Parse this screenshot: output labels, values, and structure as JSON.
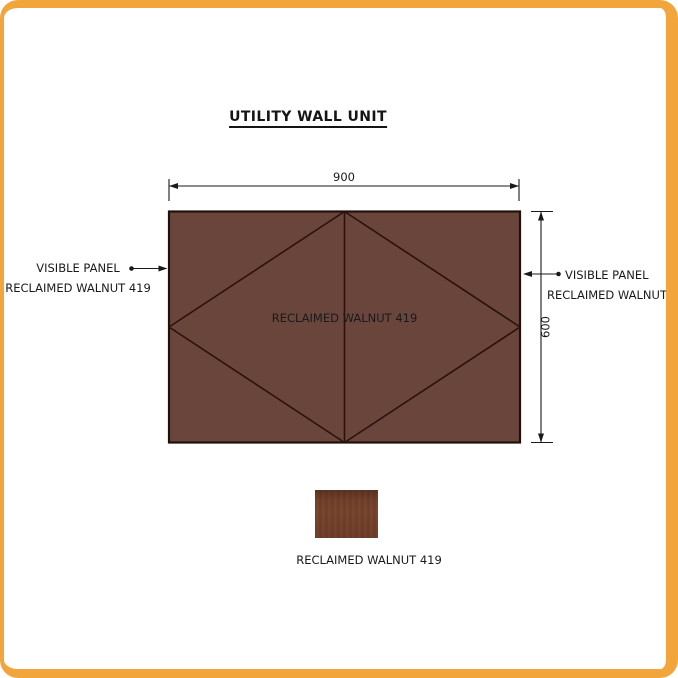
{
  "title": "UTILITY WALL UNIT",
  "panel": {
    "label": "RECLAIMED WALNUT 419",
    "width_dim": "900",
    "height_dim": "600"
  },
  "callout_left": {
    "line1": "VISIBLE PANEL",
    "line2": "RECLAIMED WALNUT 419"
  },
  "callout_right": {
    "line1": "VISIBLE PANEL",
    "line2": "RECLAIMED WALNUT 419"
  },
  "legend": {
    "label": "RECLAIMED WALNUT 419"
  },
  "colors": {
    "frame_border": "#F1A53B",
    "panel_fill": "#69453C",
    "panel_outline": "#21100A",
    "panel_pattern_line": "#2A120B",
    "panel_label_ink": "#EBE1D1",
    "annotation_ink": "#1A1A1A",
    "swatch_wood_base": "#74422F"
  }
}
